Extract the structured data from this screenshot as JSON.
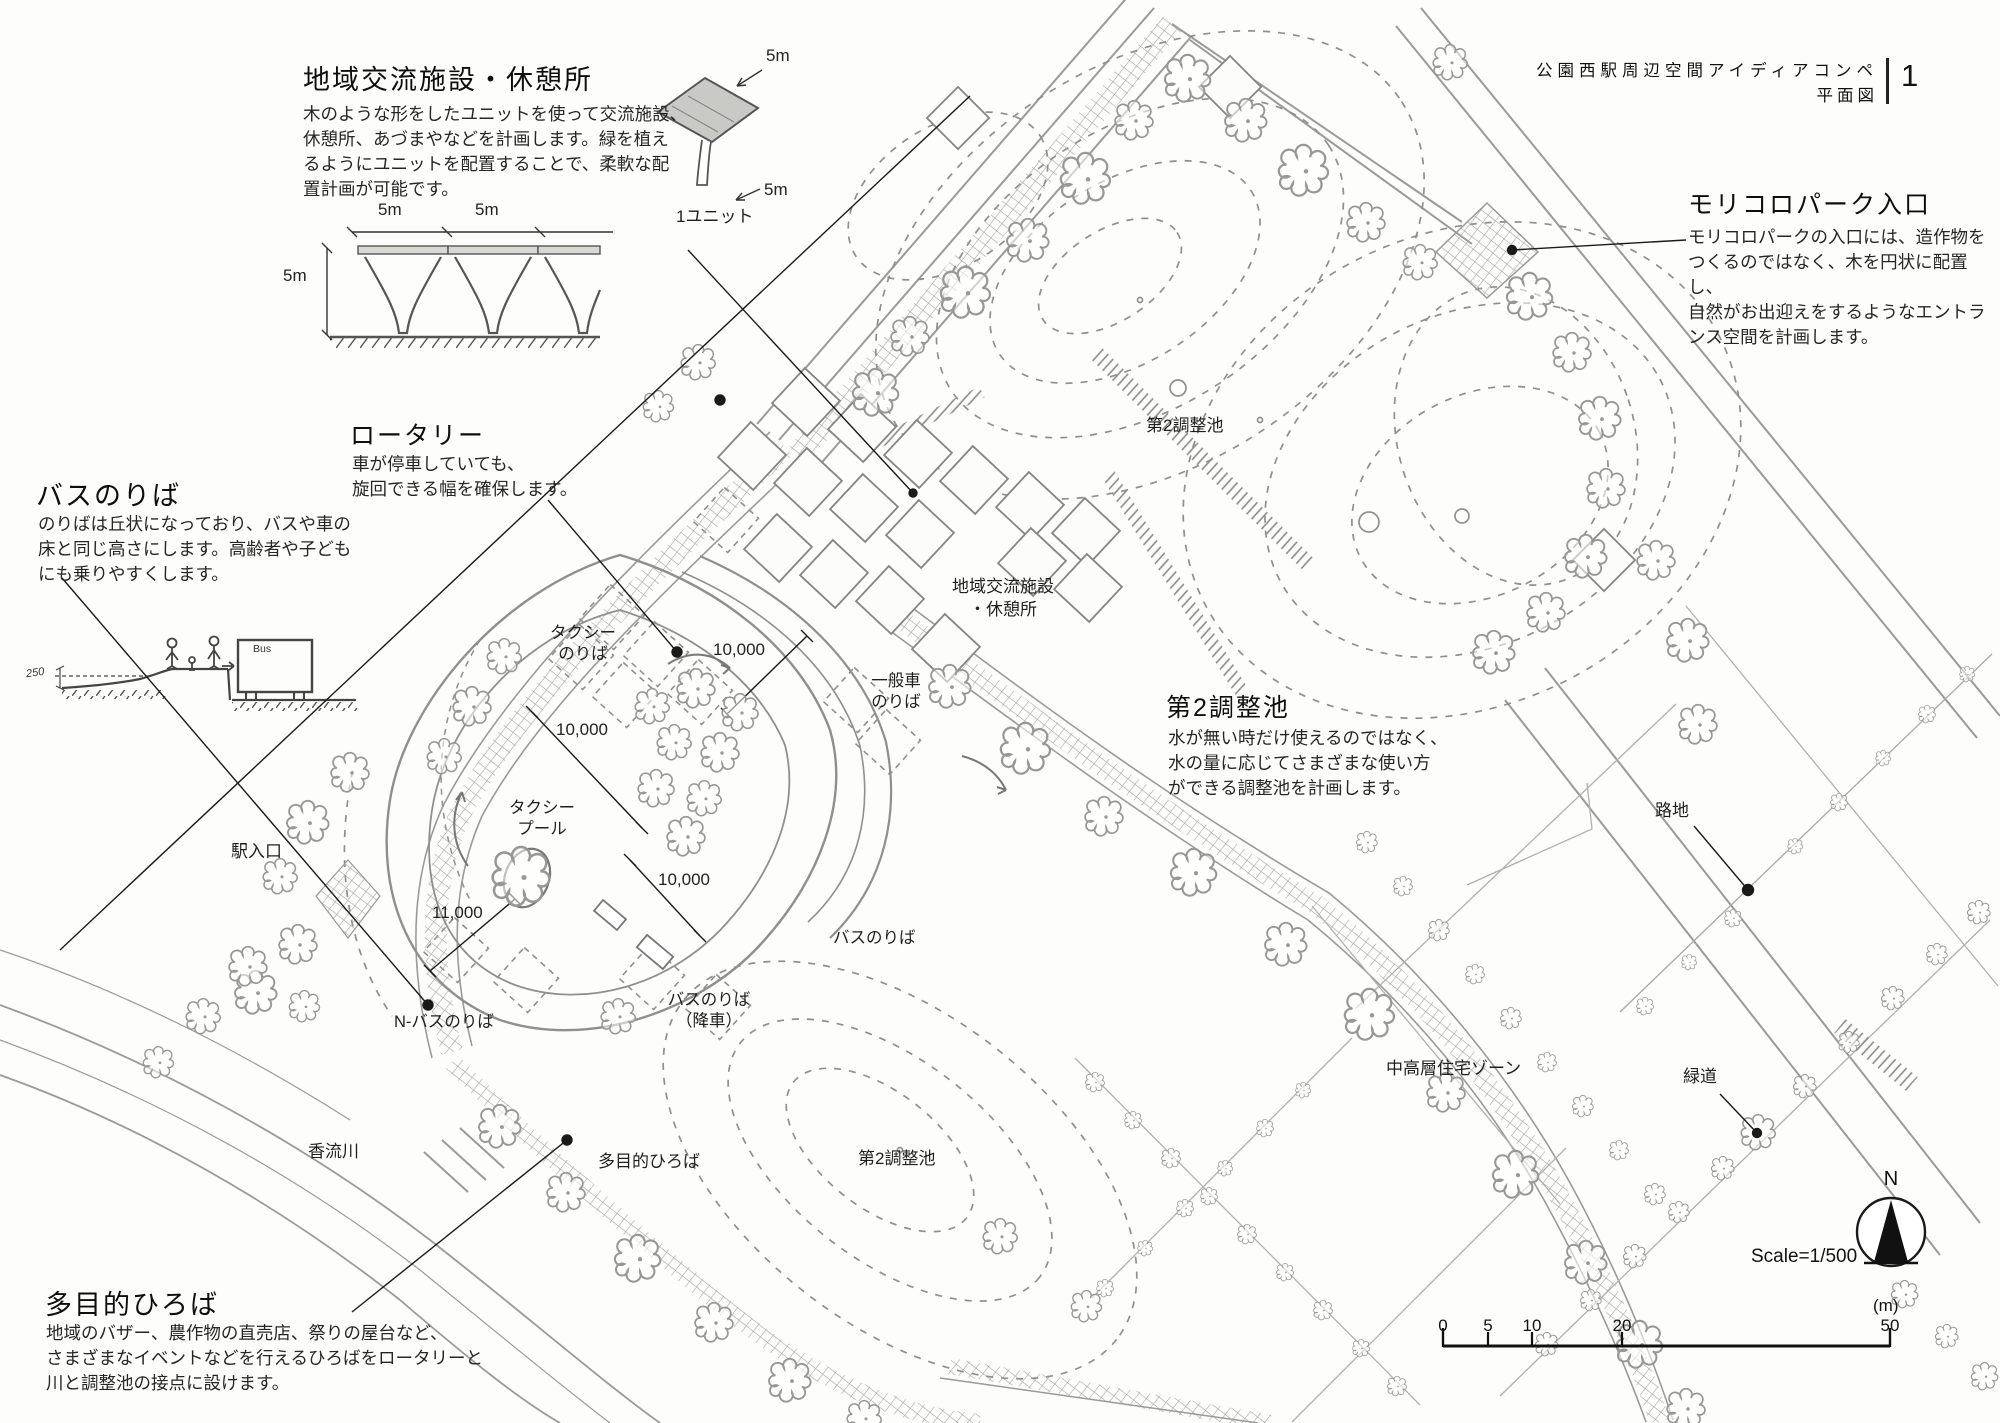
{
  "header": {
    "title": "公園西駅周辺空間アイディアコンペ",
    "subtitle": "平面図",
    "page_number": "1"
  },
  "sections": {
    "community": {
      "title": "地域交流施設・休憩所",
      "body": "木のような形をしたユニットを使って交流施設、\n休憩所、あづまやなどを計画します。緑を植え\nるようにユニットを配置することで、柔軟な配\n置計画が可能です。"
    },
    "moricoro": {
      "title": "モリコロパーク入口",
      "body": "モリコロパークの入口には、造作物を\nつくるのではなく、木を円状に配置し、\n自然がお出迎えをするようなエントラ\nンス空間を計画します。"
    },
    "bus": {
      "title": "バスのりば",
      "body": "のりばは丘状になっており、バスや車の\n床と同じ高さにします。高齢者や子ども\nにも乗りやすくします。"
    },
    "rotary": {
      "title": "ロータリー",
      "body": "車が停車していても、\n旋回できる幅を確保します。"
    },
    "pond": {
      "title": "第2調整池",
      "body": "水が無い時だけ使えるのではなく、\n水の量に応じてさまざまな使い方\nができる調整池を計画します。"
    },
    "plaza": {
      "title": "多目的ひろば",
      "body": "地域のバザー、農作物の直売店、祭りの屋台など、\nさまざまなイベントなどを行えるひろばをロータリーと\n川と調整池の接点に設けます。"
    }
  },
  "sketch": {
    "span_a": "5m",
    "span_b": "5m",
    "height": "5m",
    "axon_top": "5m",
    "axon_bottom": "5m",
    "unit_caption": "1ユニット",
    "bus_sign": "Bus",
    "platform_height": "250"
  },
  "map_labels": {
    "taxi_stop": "タクシー\nのりば",
    "general_car": "一般車\nのりば",
    "taxi_pool": "タクシー\nプール",
    "community_facility": "地域交流施設\n・休憩所",
    "pond_upper": "第2調整池",
    "pond_lower": "第2調整池",
    "bus_stop": "バスのりば",
    "bus_stop_drop": "バスのりば\n（降車）",
    "n_bus_stop": "N-バスのりば",
    "station_entrance": "駅入口",
    "river": "香流川",
    "multipurpose_plaza": "多目的ひろば",
    "residential": "中高層住宅ゾーン",
    "alley": "路地",
    "greenway": "緑道"
  },
  "dimensions": {
    "d1": "10,000",
    "d2": "10,000",
    "d3": "10,000",
    "d4": "11,000"
  },
  "legend": {
    "north": "N",
    "scale": "Scale=1/500",
    "unit": "(m)",
    "tick0": "0",
    "tick5": "5",
    "tick10": "10",
    "tick20": "20",
    "tick50": "50"
  },
  "colors": {
    "pencil": "#8f8f8f",
    "ink": "#1a1a1a",
    "paper": "#fdfdfb"
  }
}
